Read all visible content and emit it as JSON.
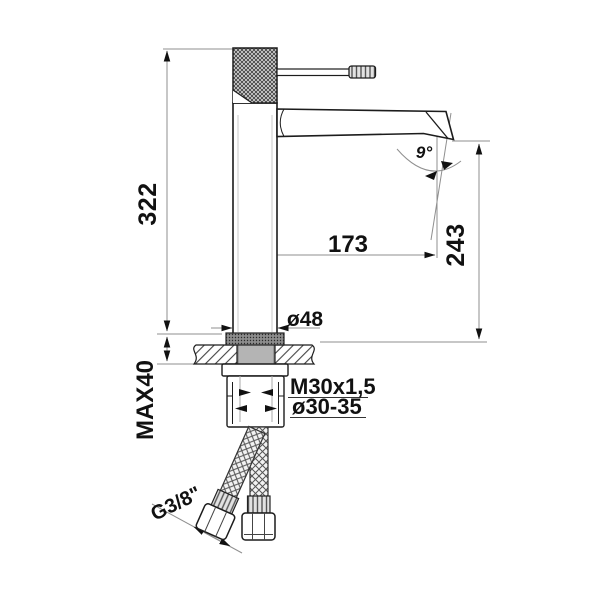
{
  "drawing": {
    "subject": "Single-lever high basin mixer tap — dimensional technical drawing",
    "units": "mm",
    "colors": {
      "background": "#ffffff",
      "outline": "#1c1c1c",
      "dimension_lines": "#8f8f8f",
      "text": "#111111",
      "shank_fill": "#b4b4b4"
    },
    "dimensions": {
      "total_height": "322",
      "max_deck_thickness": "MAX40",
      "spout_reach": "173",
      "spout_outlet_height": "243",
      "body_diameter": "ø48",
      "fixing_thread": "M30x1,5",
      "mounting_hole": "ø30-35",
      "hose_connection": "G3/8\"",
      "outlet_angle": "9°"
    }
  }
}
